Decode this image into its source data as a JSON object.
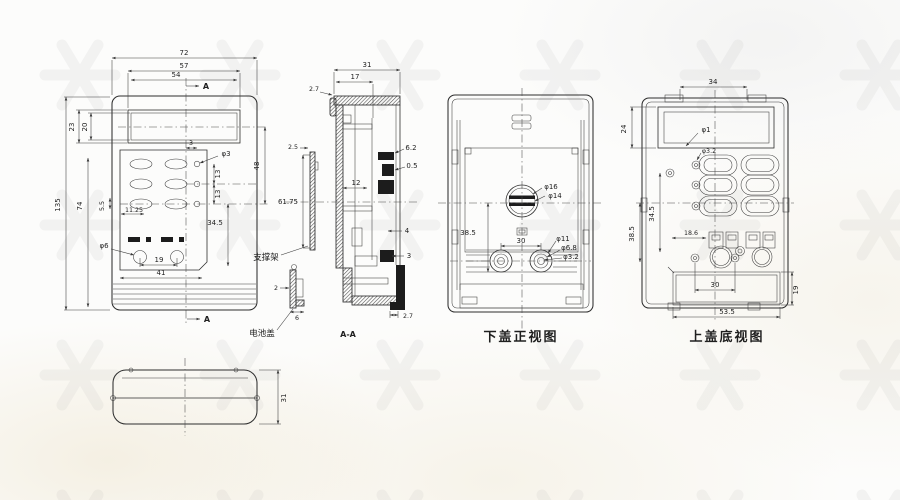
{
  "page": {
    "background": "#fcfcfb",
    "line_color": "#2e2e2e",
    "watermark_color": "#c9c9c9"
  },
  "front": {
    "section_arrow": "A",
    "dims": {
      "w72": "72",
      "w57": "57",
      "w54": "54",
      "h23": "23",
      "h20": "20",
      "h135": "135",
      "h74": "74",
      "h55": "5.5",
      "w1125": "11.25",
      "w3": "3",
      "d3": "φ3",
      "h13a": "13",
      "h13b": "13",
      "h48": "48",
      "h345": "34.5",
      "d6": "φ6",
      "w19": "19",
      "w41": "41"
    }
  },
  "section": {
    "title": "A-A",
    "dims": {
      "w31": "31",
      "w17": "17",
      "t27_top": "2.7",
      "t25": "2.5",
      "h6175": "61.75",
      "h62": "6.2",
      "t05": "0.5",
      "w12": "12",
      "t4": "4",
      "t3": "3",
      "t27_bot": "2.7",
      "t2": "2",
      "w6": "6"
    },
    "labels": {
      "support": "支撑架",
      "battery_cover": "电池盖"
    }
  },
  "bottom_cover": {
    "title": "下盖正视图",
    "dims": {
      "h385": "38.5",
      "w30": "30",
      "d16": "φ16",
      "d14": "φ14",
      "d11": "φ11",
      "d68": "φ6.8",
      "d32": "φ3.2"
    }
  },
  "top_cover": {
    "title": "上盖底视图",
    "dims": {
      "w34": "34",
      "h24": "24",
      "d1": "φ1",
      "d32": "φ3.2",
      "w186": "18.6",
      "h385": "38.5",
      "h345": "34.5",
      "w30": "30",
      "w535": "53.5",
      "h19": "19"
    }
  },
  "top_outline": {
    "dims": {
      "h31": "31"
    }
  }
}
